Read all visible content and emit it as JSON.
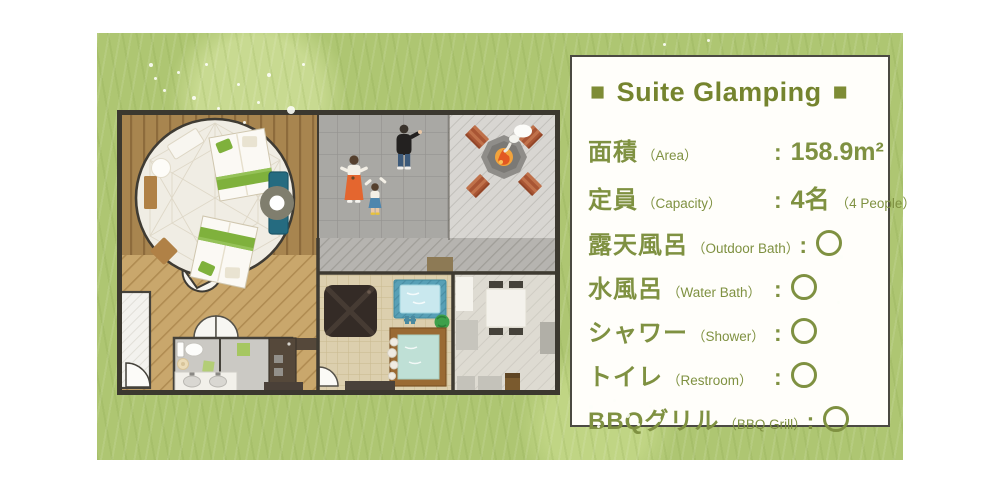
{
  "card": {
    "decor_square": "■",
    "title": "Suite Glamping",
    "rows": [
      {
        "jp": "面積",
        "en": "（Area）",
        "colon": ":",
        "value": "158.9m²"
      },
      {
        "jp": "定員",
        "en": "（Capacity）",
        "colon": ":",
        "value": "4名",
        "note": "（4 People）"
      },
      {
        "jp": "露天風呂",
        "en": "（Outdoor Bath）",
        "colon": ":",
        "value": "○",
        "status": "yes"
      },
      {
        "jp": "水風呂",
        "en": "（Water Bath）",
        "colon": ":",
        "value": "○",
        "status": "yes"
      },
      {
        "jp": "シャワー",
        "en": "（Shower）",
        "colon": ":",
        "value": "○",
        "status": "yes"
      },
      {
        "jp": "トイレ",
        "en": "（Restroom）",
        "colon": ":",
        "value": "○",
        "status": "yes"
      },
      {
        "jp": "BBQグリル",
        "en": "（BBQ Grill）",
        "colon": ":",
        "value": "○",
        "status": "yes"
      }
    ]
  },
  "colors": {
    "accent_olive": "#7E8C35",
    "text_green": "#7F9141",
    "grass_green": "#AEC672",
    "card_border": "#4B4A42",
    "deck_wood": "#A8854F",
    "deck_light": "#C9A76C",
    "patio_gray": "#A9A8A4",
    "firepit_area_gray": "#D8D6D2",
    "fire_orange": "#E76325",
    "bath_water_blue": "#C9E8EE",
    "bath_water_teal": "#BFE0D6",
    "bath_frame_wood": "#9A6A33",
    "chair_teal": "#256B80",
    "bed_green": "#7FB13C"
  },
  "floorplan_elements": [
    "wood-deck",
    "dome-tent",
    "beds",
    "round-table",
    "teal-chairs",
    "tent-entrance",
    "tile-patio",
    "person-man",
    "person-woman",
    "person-child",
    "fire-pit",
    "smoke",
    "benches",
    "walkway",
    "ottoman",
    "outdoor-bath",
    "water-bath",
    "green-bush",
    "bathroom",
    "toilet",
    "double-sink",
    "shower-stall",
    "kitchen-counter",
    "dining-room",
    "dining-table",
    "dining-chairs"
  ]
}
